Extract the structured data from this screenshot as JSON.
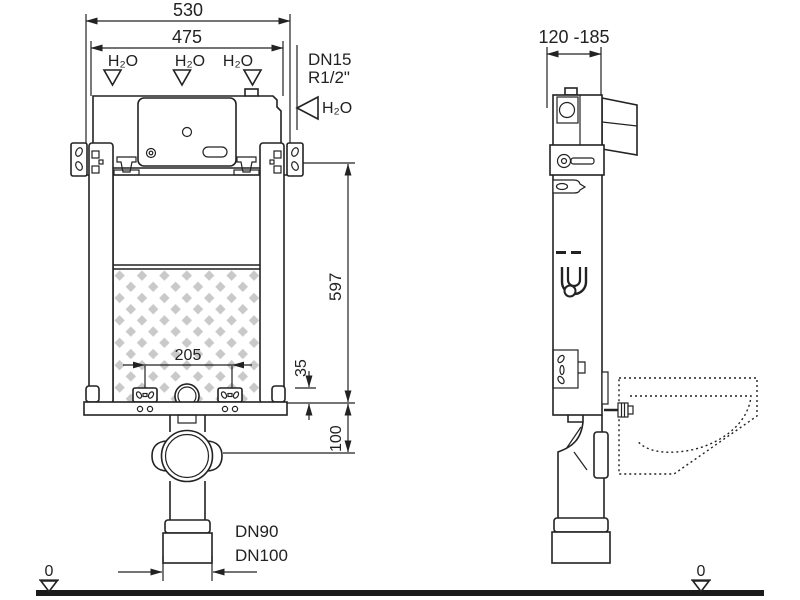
{
  "front_view": {
    "dim_width_outer": "530",
    "dim_width_inner": "475",
    "water_label_1": "H₂O",
    "water_label_2": "H₂O",
    "water_label_3": "H₂O",
    "supply": {
      "dn": "DN15",
      "thread": "R1/2\"",
      "water_label": "H₂O"
    },
    "dim_height": "597",
    "dim_bolt_spacing": "205",
    "dim_plate": "35",
    "dim_outlet_height": "100",
    "drain": {
      "dn90": "DN90",
      "dn100": "DN100"
    },
    "level_marker": "0"
  },
  "side_view": {
    "dim_depth_range": "120 -185",
    "level_marker": "0"
  },
  "colors": {
    "ink": "#222222",
    "foam_pattern": "#c9c9c9",
    "ground": "#1b1b1b",
    "background": "#ffffff"
  }
}
